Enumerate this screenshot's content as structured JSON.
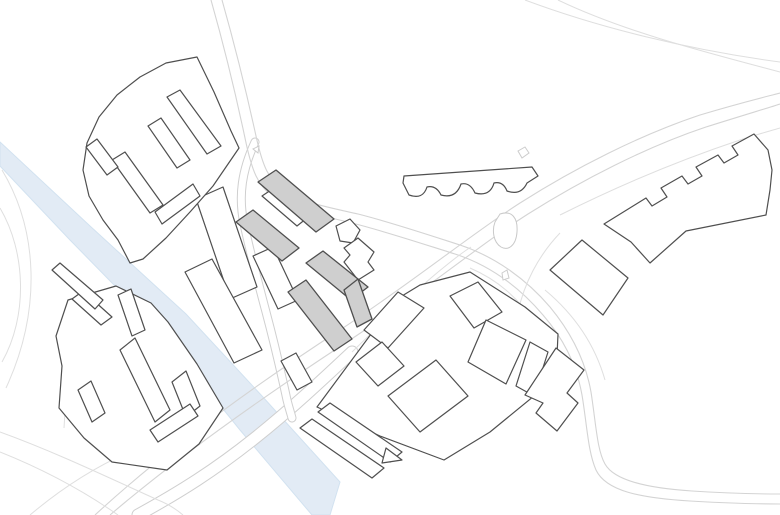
{
  "canvas": {
    "width": 780,
    "height": 515,
    "background": "#ffffff"
  },
  "palette": {
    "building_outline": "#4f4f4f",
    "building_fill_white": "#ffffff",
    "building_fill_gray": "#cfcfcf",
    "road_line": "#d4d4d4",
    "road_line_faint": "#dfdfdf",
    "river_fill": "#e2ebf5",
    "river_edge": "#d2e2f0"
  },
  "features": [
    {
      "name": "river",
      "kind": "river",
      "d": "M 0,142 L 90,226 L 186,314 L 262,396 L 340,482 L 330,515 L 312,515 L 240,430 L 164,336 L 70,240 L 0,166 Z"
    },
    {
      "name": "road-bridge-over-river",
      "kind": "cased-road",
      "w": 13,
      "d": "M 138,515 C 180,492 215,470 255,438 C 290,410 320,382 352,352"
    },
    {
      "name": "road-local-street-west",
      "kind": "cased-road",
      "w": 9,
      "d": "M 255,142 C 242,170 238,196 244,224 C 250,252 258,282 266,312 C 274,342 281,372 287,400 C 289,408 291,414 292,418"
    },
    {
      "name": "road-main-north-south-a",
      "kind": "road",
      "d": "M 211,0 C 228,60 238,105 245,138 C 252,172 258,185 272,196 C 290,210 320,215 352,223 C 384,231 420,243 455,254 C 492,266 520,288 543,315 C 562,337 576,362 582,395 C 587,425 588,452 596,470 C 606,491 640,498 690,501 C 720,503 760,504 780,504"
    },
    {
      "name": "road-main-north-south-b",
      "kind": "road",
      "d": "M 222,0 C 239,60 249,104 256,136 C 263,168 269,179 282,189 C 299,202 327,207 358,214 C 390,222 426,234 460,245 C 496,257 527,280 550,307 C 569,330 585,358 591,392 C 596,424 597,450 605,464 C 614,480 645,488 692,491 C 722,493 760,494 780,494"
    },
    {
      "name": "road-highway-a",
      "kind": "road",
      "d": "M 95,515 C 160,455 240,395 340,330 C 420,277 470,235 520,203 C 575,168 640,135 700,115 C 740,103 765,97 780,93"
    },
    {
      "name": "road-highway-b",
      "kind": "road",
      "d": "M 110,515 C 172,462 252,404 350,340 C 430,287 478,246 528,214 C 582,180 646,147 706,127 C 744,115 768,108 780,104"
    },
    {
      "name": "road-highway-outer-lane",
      "kind": "road-faint",
      "d": "M 560,215 C 620,185 680,160 740,140 C 755,135 770,131 780,128"
    },
    {
      "name": "road-connector-diagonal",
      "kind": "road-faint",
      "d": "M 352,352 C 385,320 418,288 443,268 C 454,259 463,252 471,247"
    },
    {
      "name": "road-top-right-corner-a",
      "kind": "road-faint",
      "d": "M 525,0 C 600,28 690,50 780,62"
    },
    {
      "name": "road-top-right-corner-b",
      "kind": "road-faint",
      "d": "M 558,0 C 625,32 705,52 780,72"
    },
    {
      "name": "road-west-loop-arc-outer",
      "kind": "road-faint",
      "d": "M 2,170 C 38,230 42,310 6,388"
    },
    {
      "name": "road-west-loop-arc-inner",
      "kind": "road-faint",
      "d": "M 0,208 C 26,252 28,316 2,362"
    },
    {
      "name": "road-southwest-a",
      "kind": "road-faint",
      "d": "M 0,432 C 55,452 105,476 158,500 C 168,504 176,509 183,515"
    },
    {
      "name": "road-southwest-b",
      "kind": "road-faint",
      "d": "M 0,452 C 45,470 85,492 118,515"
    },
    {
      "name": "road-southwest-diagonal",
      "kind": "road-faint",
      "d": "M 30,515 C 62,488 96,466 134,450"
    },
    {
      "name": "road-west-spur",
      "kind": "road-faint",
      "d": "M 70,330 C 68,364 66,396 64,428"
    },
    {
      "name": "road-interchange-ramp-east",
      "kind": "road-faint",
      "d": "M 470,268 C 498,280 518,298 534,322"
    },
    {
      "name": "road-interchange-ramp-south",
      "kind": "road-faint",
      "d": "M 560,233 C 538,256 524,284 518,312 C 514,330 522,348 540,366"
    },
    {
      "name": "road-southeast-echo",
      "kind": "road-faint",
      "d": "M 545,290 C 575,315 595,345 605,380"
    },
    {
      "name": "traffic-island-north",
      "kind": "island",
      "points": [
        [
          253,
          149
        ],
        [
          259,
          146
        ],
        [
          258,
          153
        ]
      ]
    },
    {
      "name": "traffic-island-center-a",
      "kind": "island",
      "points": [
        [
          449,
          337
        ],
        [
          455,
          333
        ],
        [
          457,
          341
        ],
        [
          451,
          344
        ]
      ]
    },
    {
      "name": "traffic-island-center-b",
      "kind": "island",
      "points": [
        [
          455,
          348
        ],
        [
          461,
          344
        ],
        [
          462,
          352
        ],
        [
          456,
          354
        ]
      ]
    },
    {
      "name": "traffic-island-east",
      "kind": "island",
      "points": [
        [
          502,
          273
        ],
        [
          507,
          270
        ],
        [
          509,
          278
        ],
        [
          503,
          280
        ]
      ]
    },
    {
      "name": "traffic-island-diamond",
      "kind": "island",
      "points": [
        [
          518,
          151
        ],
        [
          525,
          147
        ],
        [
          529,
          153
        ],
        [
          522,
          158
        ]
      ]
    },
    {
      "name": "landform-blob",
      "kind": "blob",
      "d": "M 500,214 C 512,210 518,218 517,232 C 516,246 508,251 501,247 C 493,242 492,230 495,222 Z"
    },
    {
      "name": "block-southwest-perimeter",
      "kind": "block-outline",
      "points": [
        [
          68,
          300
        ],
        [
          116,
          286
        ],
        [
          151,
          303
        ],
        [
          168,
          322
        ],
        [
          197,
          364
        ],
        [
          223,
          408
        ],
        [
          199,
          444
        ],
        [
          167,
          470
        ],
        [
          112,
          462
        ],
        [
          84,
          438
        ],
        [
          59,
          408
        ],
        [
          62,
          366
        ],
        [
          56,
          336
        ]
      ]
    },
    {
      "name": "building-sw-bar-a",
      "kind": "building",
      "points": [
        [
          72,
          299
        ],
        [
          83,
          291
        ],
        [
          112,
          317
        ],
        [
          101,
          325
        ]
      ]
    },
    {
      "name": "building-sw-bar-b",
      "kind": "building",
      "points": [
        [
          118,
          295
        ],
        [
          131,
          289
        ],
        [
          145,
          330
        ],
        [
          132,
          336
        ]
      ]
    },
    {
      "name": "building-sw-bar-center",
      "kind": "building",
      "points": [
        [
          120,
          350
        ],
        [
          135,
          338
        ],
        [
          170,
          410
        ],
        [
          155,
          422
        ]
      ]
    },
    {
      "name": "building-sw-bar-east",
      "kind": "building",
      "points": [
        [
          172,
          382
        ],
        [
          186,
          371
        ],
        [
          200,
          406
        ],
        [
          186,
          417
        ]
      ]
    },
    {
      "name": "building-sw-bar-west",
      "kind": "building",
      "points": [
        [
          78,
          390
        ],
        [
          91,
          381
        ],
        [
          105,
          413
        ],
        [
          92,
          422
        ]
      ]
    },
    {
      "name": "building-sw-bar-south",
      "kind": "building",
      "points": [
        [
          150,
          430
        ],
        [
          190,
          404
        ],
        [
          198,
          416
        ],
        [
          158,
          442
        ]
      ]
    },
    {
      "name": "block-south-perimeter",
      "kind": "block-outline",
      "points": [
        [
          317,
          407
        ],
        [
          397,
          299
        ],
        [
          420,
          285
        ],
        [
          470,
          272
        ],
        [
          525,
          307
        ],
        [
          558,
          334
        ],
        [
          556,
          378
        ],
        [
          490,
          432
        ],
        [
          444,
          460
        ],
        [
          380,
          436
        ]
      ]
    },
    {
      "name": "building-south-slab-nw",
      "kind": "building",
      "points": [
        [
          398,
          292
        ],
        [
          424,
          308
        ],
        [
          388,
          348
        ],
        [
          364,
          330
        ]
      ]
    },
    {
      "name": "building-south-slab-small",
      "kind": "building",
      "points": [
        [
          356,
          362
        ],
        [
          382,
          342
        ],
        [
          404,
          366
        ],
        [
          378,
          386
        ]
      ]
    },
    {
      "name": "building-south-slab-center",
      "kind": "building",
      "points": [
        [
          388,
          396
        ],
        [
          436,
          360
        ],
        [
          468,
          396
        ],
        [
          420,
          432
        ]
      ]
    },
    {
      "name": "building-south-slab-ne",
      "kind": "building",
      "points": [
        [
          450,
          296
        ],
        [
          478,
          282
        ],
        [
          502,
          312
        ],
        [
          474,
          328
        ]
      ]
    },
    {
      "name": "building-south-slab-east",
      "kind": "building",
      "points": [
        [
          486,
          320
        ],
        [
          526,
          340
        ],
        [
          506,
          384
        ],
        [
          468,
          362
        ]
      ]
    },
    {
      "name": "building-south-slab-far-east",
      "kind": "building",
      "points": [
        [
          530,
          342
        ],
        [
          548,
          352
        ],
        [
          534,
          396
        ],
        [
          516,
          386
        ]
      ]
    },
    {
      "name": "building-south-sliver-a",
      "kind": "building",
      "points": [
        [
          300,
          428
        ],
        [
          312,
          419
        ],
        [
          384,
          468
        ],
        [
          372,
          478
        ]
      ]
    },
    {
      "name": "building-south-sliver-b",
      "kind": "building",
      "points": [
        [
          318,
          412
        ],
        [
          330,
          403
        ],
        [
          402,
          452
        ],
        [
          390,
          462
        ]
      ]
    },
    {
      "name": "building-south-triangle",
      "kind": "building",
      "points": [
        [
          386,
          448
        ],
        [
          402,
          460
        ],
        [
          382,
          463
        ]
      ]
    },
    {
      "name": "building-west-slab-long-a",
      "kind": "building",
      "points": [
        [
          196,
          199
        ],
        [
          223,
          187
        ],
        [
          257,
          287
        ],
        [
          230,
          299
        ]
      ]
    },
    {
      "name": "building-west-slab-long-b",
      "kind": "building",
      "points": [
        [
          185,
          272
        ],
        [
          212,
          259
        ],
        [
          262,
          350
        ],
        [
          234,
          363
        ]
      ]
    },
    {
      "name": "building-west-slab-mid",
      "kind": "building",
      "points": [
        [
          253,
          256
        ],
        [
          273,
          247
        ],
        [
          298,
          300
        ],
        [
          278,
          309
        ]
      ]
    },
    {
      "name": "building-west-slab-low",
      "kind": "building",
      "points": [
        [
          281,
          361
        ],
        [
          296,
          353
        ],
        [
          312,
          382
        ],
        [
          297,
          390
        ]
      ]
    },
    {
      "name": "building-west-small-bar",
      "kind": "building",
      "points": [
        [
          52,
          270
        ],
        [
          60,
          263
        ],
        [
          103,
          300
        ],
        [
          95,
          309
        ]
      ]
    },
    {
      "name": "block-northwest-crescent",
      "kind": "block-outline",
      "points": [
        [
          197,
          57
        ],
        [
          214,
          92
        ],
        [
          231,
          131
        ],
        [
          239,
          148
        ],
        [
          213,
          186
        ],
        [
          190,
          212
        ],
        [
          166,
          238
        ],
        [
          143,
          259
        ],
        [
          130,
          263
        ],
        [
          118,
          240
        ],
        [
          103,
          220
        ],
        [
          89,
          196
        ],
        [
          83,
          170
        ],
        [
          87,
          143
        ],
        [
          99,
          117
        ],
        [
          117,
          95
        ],
        [
          140,
          77
        ],
        [
          166,
          63
        ]
      ]
    },
    {
      "name": "building-nw-inner-spine",
      "kind": "building",
      "points": [
        [
          167,
          97
        ],
        [
          180,
          90
        ],
        [
          221,
          146
        ],
        [
          207,
          154
        ]
      ]
    },
    {
      "name": "building-nw-inner-mid",
      "kind": "building",
      "points": [
        [
          148,
          126
        ],
        [
          161,
          118
        ],
        [
          190,
          160
        ],
        [
          177,
          168
        ]
      ]
    },
    {
      "name": "building-nw-inner-low",
      "kind": "building",
      "points": [
        [
          112,
          160
        ],
        [
          125,
          152
        ],
        [
          163,
          205
        ],
        [
          150,
          213
        ]
      ]
    },
    {
      "name": "building-nw-inner-west",
      "kind": "building",
      "points": [
        [
          86,
          147
        ],
        [
          97,
          139
        ],
        [
          118,
          167
        ],
        [
          107,
          175
        ]
      ]
    },
    {
      "name": "building-nw-inner-diag",
      "kind": "building",
      "points": [
        [
          155,
          212
        ],
        [
          193,
          184
        ],
        [
          200,
          196
        ],
        [
          162,
          224
        ]
      ]
    },
    {
      "name": "building-center-white-between",
      "kind": "building",
      "points": [
        [
          262,
          196
        ],
        [
          277,
          186
        ],
        [
          312,
          214
        ],
        [
          297,
          226
        ]
      ]
    },
    {
      "name": "building-center-pentagon",
      "kind": "building",
      "points": [
        [
          336,
          226
        ],
        [
          350,
          219
        ],
        [
          360,
          230
        ],
        [
          353,
          243
        ],
        [
          340,
          241
        ]
      ]
    },
    {
      "name": "building-center-irregular",
      "kind": "building",
      "points": [
        [
          344,
          248
        ],
        [
          358,
          238
        ],
        [
          374,
          252
        ],
        [
          368,
          262
        ],
        [
          374,
          270
        ],
        [
          358,
          280
        ],
        [
          344,
          262
        ],
        [
          350,
          255
        ]
      ]
    },
    {
      "name": "building-gray-north-bar",
      "kind": "building-gray",
      "points": [
        [
          258,
          182
        ],
        [
          276,
          170
        ],
        [
          334,
          219
        ],
        [
          316,
          232
        ]
      ]
    },
    {
      "name": "building-gray-west-bar",
      "kind": "building-gray",
      "points": [
        [
          236,
          222
        ],
        [
          253,
          210
        ],
        [
          299,
          248
        ],
        [
          282,
          261
        ]
      ]
    },
    {
      "name": "building-gray-l-upper",
      "kind": "building-gray",
      "points": [
        [
          306,
          263
        ],
        [
          323,
          251
        ],
        [
          368,
          287
        ],
        [
          351,
          300
        ]
      ]
    },
    {
      "name": "building-gray-l-arm",
      "kind": "building-gray",
      "points": [
        [
          344,
          290
        ],
        [
          358,
          279
        ],
        [
          372,
          319
        ],
        [
          357,
          327
        ]
      ]
    },
    {
      "name": "building-gray-l-lower",
      "kind": "building-gray",
      "points": [
        [
          288,
          292
        ],
        [
          306,
          280
        ],
        [
          352,
          339
        ],
        [
          334,
          351
        ]
      ]
    },
    {
      "name": "building-scalloped",
      "kind": "building",
      "d": "M 403,183 L 404,176 L 532,167 L 538,176 L 527,183 Q 521,196 507,191 Q 503,181 494,183 Q 490,197 475,193 Q 470,182 461,184 Q 456,199 441,195 Q 436,185 427,187 Q 423,200 409,195 Z"
    },
    {
      "name": "building-east-notched",
      "kind": "building",
      "d": "M 604,224 L 646,198 L 652,206 L 667,197 L 661,188 L 682,176 L 688,184 L 702,176 L 696,167 L 718,155 L 724,163 L 738,155 L 732,146 L 754,134 L 768,150 L 772,170 L 770,190 L 766,215 L 686,231 L 650,263 L 631,242 L 616,232 Z"
    },
    {
      "name": "building-east-quad",
      "kind": "building",
      "points": [
        [
          550,
          270
        ],
        [
          582,
          240
        ],
        [
          628,
          278
        ],
        [
          603,
          315
        ]
      ]
    },
    {
      "name": "building-southeast-chevron",
      "kind": "building",
      "points": [
        [
          525,
          395
        ],
        [
          556,
          348
        ],
        [
          584,
          370
        ],
        [
          567,
          393
        ],
        [
          578,
          403
        ],
        [
          557,
          431
        ],
        [
          536,
          413
        ],
        [
          543,
          403
        ]
      ]
    }
  ]
}
